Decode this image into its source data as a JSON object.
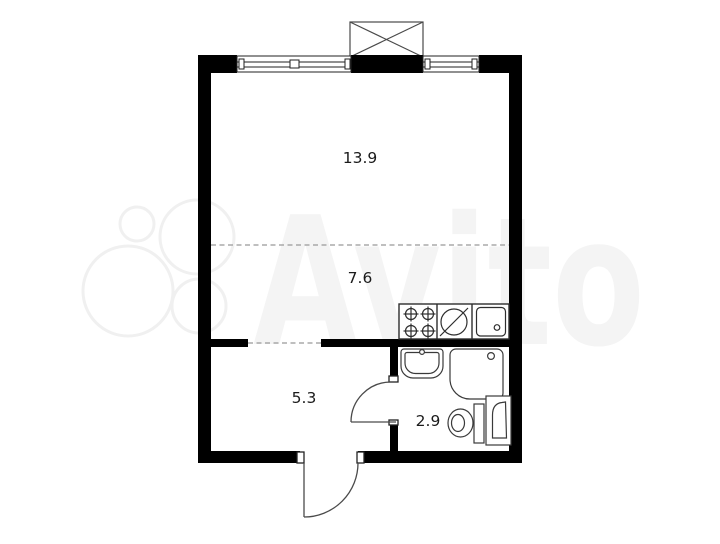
{
  "floorplan": {
    "type": "studio-apartment-plan",
    "rooms": [
      {
        "id": "living",
        "area_label": "13.9"
      },
      {
        "id": "kitchen",
        "area_label": "7.6"
      },
      {
        "id": "hallway",
        "area_label": "5.3"
      },
      {
        "id": "bathroom",
        "area_label": "2.9"
      }
    ],
    "watermark": {
      "brand": "Avito"
    },
    "fixtures": [
      "stove",
      "kitchen-sink",
      "bathroom-sink",
      "shower",
      "toilet",
      "washing-machine",
      "ventilation-shaft"
    ],
    "colors": {
      "wall": "#000000",
      "outline": "#3a3a3a",
      "dashed_line": "#999999",
      "watermark": "#f4f4f4",
      "background": "#ffffff"
    }
  }
}
